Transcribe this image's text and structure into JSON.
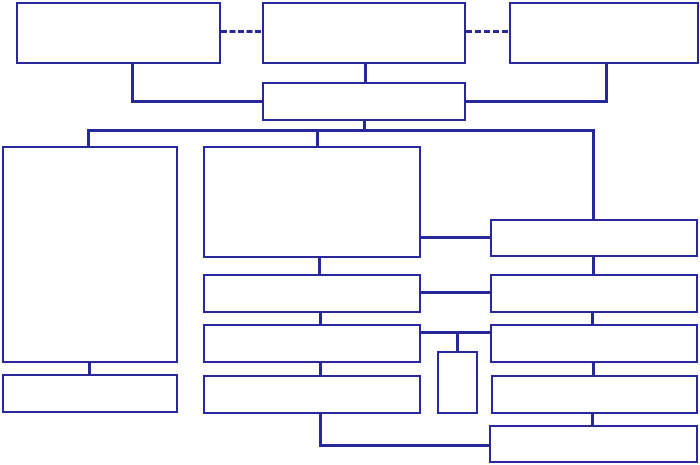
{
  "diagram": {
    "type": "flowchart-org-chart",
    "title": "",
    "background_color": "#ffffff",
    "line_color": "#28289a",
    "box_fill_color": "#ffffff",
    "nodes": [
      {
        "id": "exec-left",
        "label": "",
        "shape": "rect"
      },
      {
        "id": "exec-center",
        "label": "",
        "shape": "rect"
      },
      {
        "id": "exec-right",
        "label": "",
        "shape": "rect"
      },
      {
        "id": "hub",
        "label": "",
        "shape": "rect"
      },
      {
        "id": "left-main",
        "label": "",
        "shape": "rect"
      },
      {
        "id": "left-footer",
        "label": "",
        "shape": "rect"
      },
      {
        "id": "center-main",
        "label": "",
        "shape": "rect"
      },
      {
        "id": "center-row-1",
        "label": "",
        "shape": "rect"
      },
      {
        "id": "center-row-2",
        "label": "",
        "shape": "rect"
      },
      {
        "id": "center-row-3",
        "label": "",
        "shape": "rect"
      },
      {
        "id": "small-upright",
        "label": "",
        "shape": "rect"
      },
      {
        "id": "right-1",
        "label": "",
        "shape": "rect"
      },
      {
        "id": "right-2",
        "label": "",
        "shape": "rect"
      },
      {
        "id": "right-3",
        "label": "",
        "shape": "rect"
      },
      {
        "id": "right-4",
        "label": "",
        "shape": "rect"
      },
      {
        "id": "right-5",
        "label": "",
        "shape": "rect"
      }
    ],
    "edges": [
      {
        "from": "exec-left",
        "to": "exec-center",
        "style": "dashed"
      },
      {
        "from": "exec-center",
        "to": "exec-right",
        "style": "dashed"
      },
      {
        "from": "exec-left",
        "to": "hub",
        "style": "solid"
      },
      {
        "from": "exec-center",
        "to": "hub",
        "style": "solid"
      },
      {
        "from": "exec-right",
        "to": "hub",
        "style": "solid"
      },
      {
        "from": "hub",
        "to": "left-main",
        "style": "solid"
      },
      {
        "from": "hub",
        "to": "center-main",
        "style": "solid"
      },
      {
        "from": "hub",
        "to": "right-1",
        "style": "solid"
      },
      {
        "from": "left-main",
        "to": "left-footer",
        "style": "solid"
      },
      {
        "from": "center-main",
        "to": "center-row-1",
        "style": "solid"
      },
      {
        "from": "center-row-1",
        "to": "center-row-2",
        "style": "solid"
      },
      {
        "from": "center-row-2",
        "to": "center-row-3",
        "style": "solid"
      },
      {
        "from": "center-row-3",
        "to": "right-5",
        "style": "solid"
      },
      {
        "from": "center-main",
        "to": "right-1",
        "style": "solid"
      },
      {
        "from": "center-row-1",
        "to": "right-2",
        "style": "solid"
      },
      {
        "from": "center-row-2",
        "to": "right-3",
        "style": "solid"
      },
      {
        "from": "center-row-2",
        "to": "small-upright",
        "style": "solid"
      },
      {
        "from": "right-1",
        "to": "right-2",
        "style": "solid"
      },
      {
        "from": "right-2",
        "to": "right-3",
        "style": "solid"
      },
      {
        "from": "right-3",
        "to": "right-4",
        "style": "solid"
      },
      {
        "from": "right-4",
        "to": "right-5",
        "style": "solid"
      }
    ]
  }
}
